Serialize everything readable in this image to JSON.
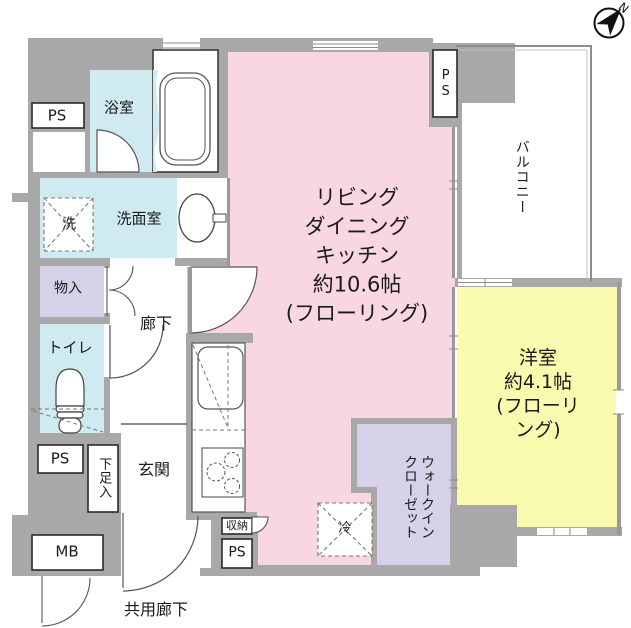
{
  "title": "マンション間取り図",
  "compass": {
    "north_label": "N"
  },
  "rooms": {
    "ldk": {
      "label": "リビング\nダイニング\nキッチン\n約10.6帖\n(フローリング)",
      "size_jo": "約10.6帖"
    },
    "western_room": {
      "label": "洋室\n約4.1帖\n(フローリング)",
      "size_jo": "約4.1帖"
    },
    "bathroom": {
      "label": "浴室"
    },
    "washroom": {
      "label": "洗面室"
    },
    "toilet": {
      "label": "トイレ"
    },
    "hallway": {
      "label": "廊下"
    },
    "entrance": {
      "label": "玄関"
    },
    "storage": {
      "label": "物入"
    },
    "walk_in_closet": {
      "label": "ウォークイン\nクローゼット"
    },
    "balcony": {
      "label": "バルコニー"
    },
    "common_corridor": {
      "label": "共用廊下"
    },
    "closet": {
      "label": "収納"
    },
    "shoe_cabinet": {
      "label": "下足入"
    }
  },
  "fixtures": {
    "washing_machine": "洗",
    "refrigerator": "冷"
  },
  "shafts": {
    "ps_top_left": "PS",
    "ps_top_right": "PS",
    "ps_mid_left": "PS",
    "ps_bottom": "PS",
    "meter_box": "MB"
  },
  "colors": {
    "wall": "#a8a8a8",
    "ldk": "#f8d7e3",
    "bedroom": "#fafaaf",
    "water": "#cfeaf0",
    "closet": "#d6d1e9",
    "background": "#ffffff",
    "line": "#555555"
  }
}
